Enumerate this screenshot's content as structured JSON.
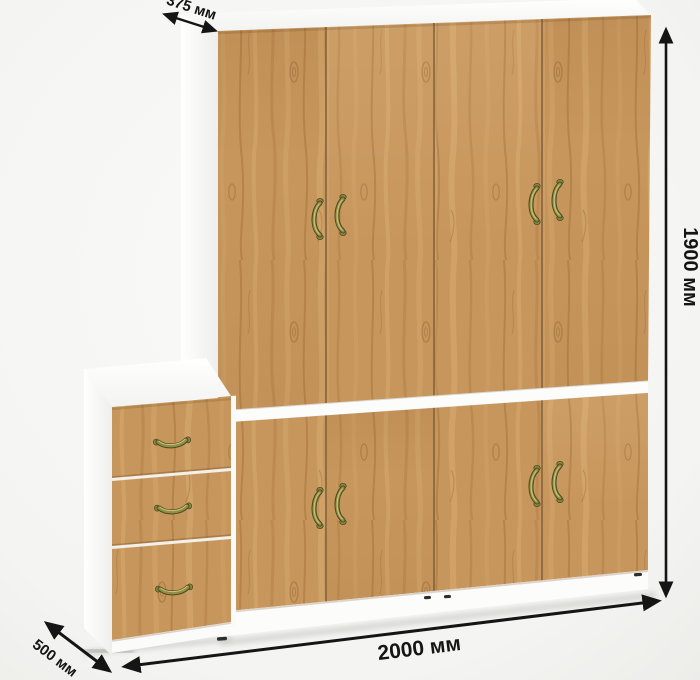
{
  "diagram": {
    "kind": "furniture-dimension-diagram",
    "dimensions": {
      "depth_top": "375 мм",
      "height": "1900 мм",
      "width": "2000 мм",
      "depth_bottom": "500 мм"
    },
    "components": {
      "wardrobe": {
        "upper_door_count": 4,
        "lower_door_count": 4
      },
      "drawer_cabinet": {
        "drawer_count": 3
      }
    },
    "icons": {
      "dimension_arrow_icon": "↔"
    },
    "colors": {
      "wood_base": "#c7965c",
      "wood_dark": "#a5733d",
      "wood_light": "#dfb77d",
      "carcass_white": "#fcfcfb",
      "handle_brass": "#8a8742",
      "handle_brass_dark": "#4b4a20",
      "dimension_line": "#151515",
      "background": "#f4f4f2"
    }
  }
}
